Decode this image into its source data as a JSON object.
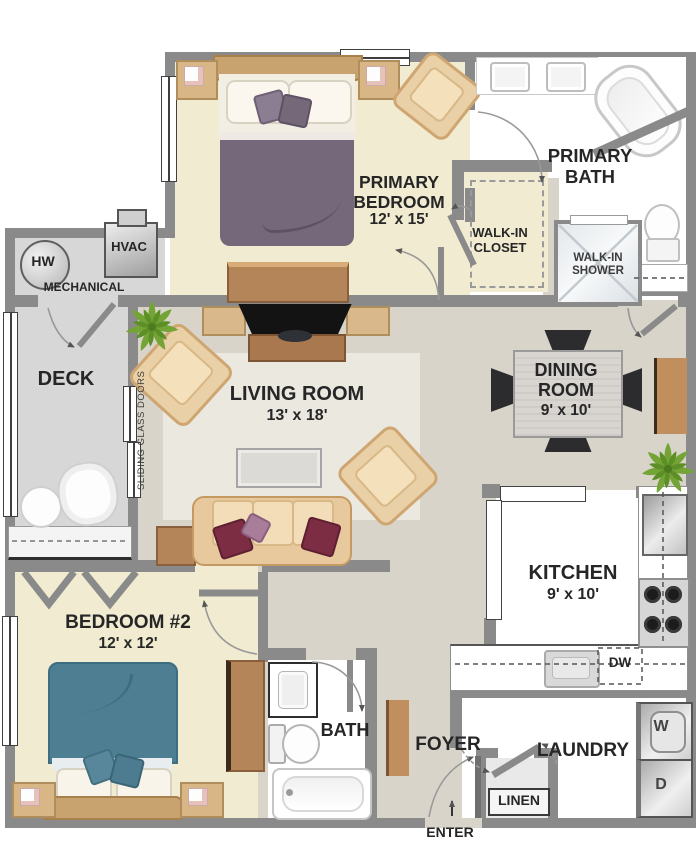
{
  "title": "Two bedroom apartment floor plan",
  "colors": {
    "wall": "#8a8a8a",
    "bedroom_floor": "#f1ebd1",
    "living_floor": "#d9d4ca",
    "rug": "#ebe8e0",
    "deck_floor": "#d7d7d7",
    "bath_floor": "#ffffff",
    "wood_tan": "#ead0a6",
    "wood_brown": "#b5855a",
    "primary_bed_blanket": "#75687b",
    "bed2_blanket": "#4d7e92",
    "accent_pillow": "#7c2d44",
    "dining_chair": "#2c2c2e",
    "plant_green": "#74a336"
  },
  "rooms": {
    "primary_bedroom": {
      "name": "PRIMARY BEDROOM",
      "dims": "12' x 15'"
    },
    "primary_bath": {
      "name": "PRIMARY BATH"
    },
    "walk_in_closet": {
      "name": "WALK-IN CLOSET"
    },
    "walk_in_shower": {
      "name": "WALK-IN SHOWER"
    },
    "mechanical": {
      "name": "MECHANICAL",
      "water_heater": "HW",
      "hvac": "HVAC"
    },
    "deck": {
      "name": "DECK"
    },
    "living_room": {
      "name": "LIVING ROOM",
      "dims": "13' x 18'"
    },
    "dining_room": {
      "name": "DINING ROOM",
      "dims": "9' x 10'"
    },
    "kitchen": {
      "name": "KITCHEN",
      "dims": "9' x 10'",
      "dishwasher": "DW"
    },
    "bedroom_2": {
      "name": "BEDROOM #2",
      "dims": "12' x 12'"
    },
    "bath": {
      "name": "BATH"
    },
    "foyer": {
      "name": "FOYER"
    },
    "laundry": {
      "name": "LAUNDRY",
      "washer": "W",
      "dryer": "D"
    },
    "linen": {
      "name": "LINEN"
    }
  },
  "annotations": {
    "entry": "ENTER",
    "sliding_doors": "SLIDING GLASS DOORS"
  }
}
